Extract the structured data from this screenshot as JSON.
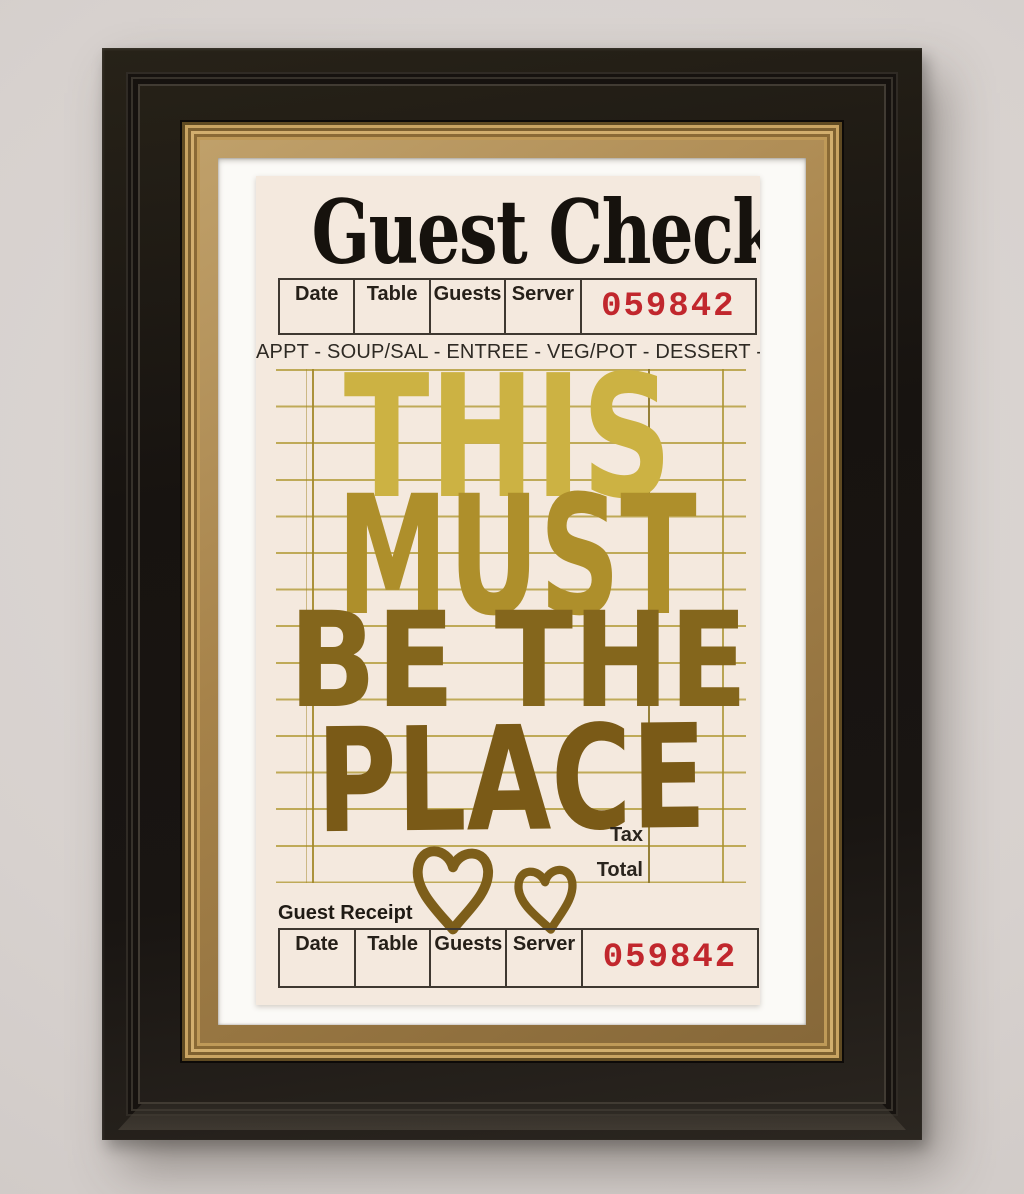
{
  "artwork": {
    "title": "Guest Check",
    "course_line": "APPT - SOUP/SAL - ENTREE - VEG/POT - DESSERT - BEV",
    "header_table": {
      "columns": [
        "Date",
        "Table",
        "Guests",
        "Server"
      ],
      "check_number": "059842"
    },
    "handwriting": {
      "line1": "THIS",
      "line2": "MUST",
      "line3": "BE THE",
      "line4": "PLACE"
    },
    "totals": {
      "tax_label": "Tax",
      "total_label": "Total"
    },
    "receipt_section": {
      "label": "Guest Receipt",
      "columns": [
        "Date",
        "Table",
        "Guests",
        "Server"
      ],
      "check_number": "059842"
    },
    "colors": {
      "check_number_red": "#c1272d",
      "paper_cream": "#f4e9de",
      "ledger_line_gold": "#b29a36",
      "handwriting_gold_top": "#ccb243",
      "handwriting_gold_bottom": "#7a5a17",
      "frame_black": "#1a1614",
      "frame_gold_trim": "#b08c52",
      "mat_white": "#fbfaf7",
      "wall_grey": "#d7d1ce"
    }
  }
}
